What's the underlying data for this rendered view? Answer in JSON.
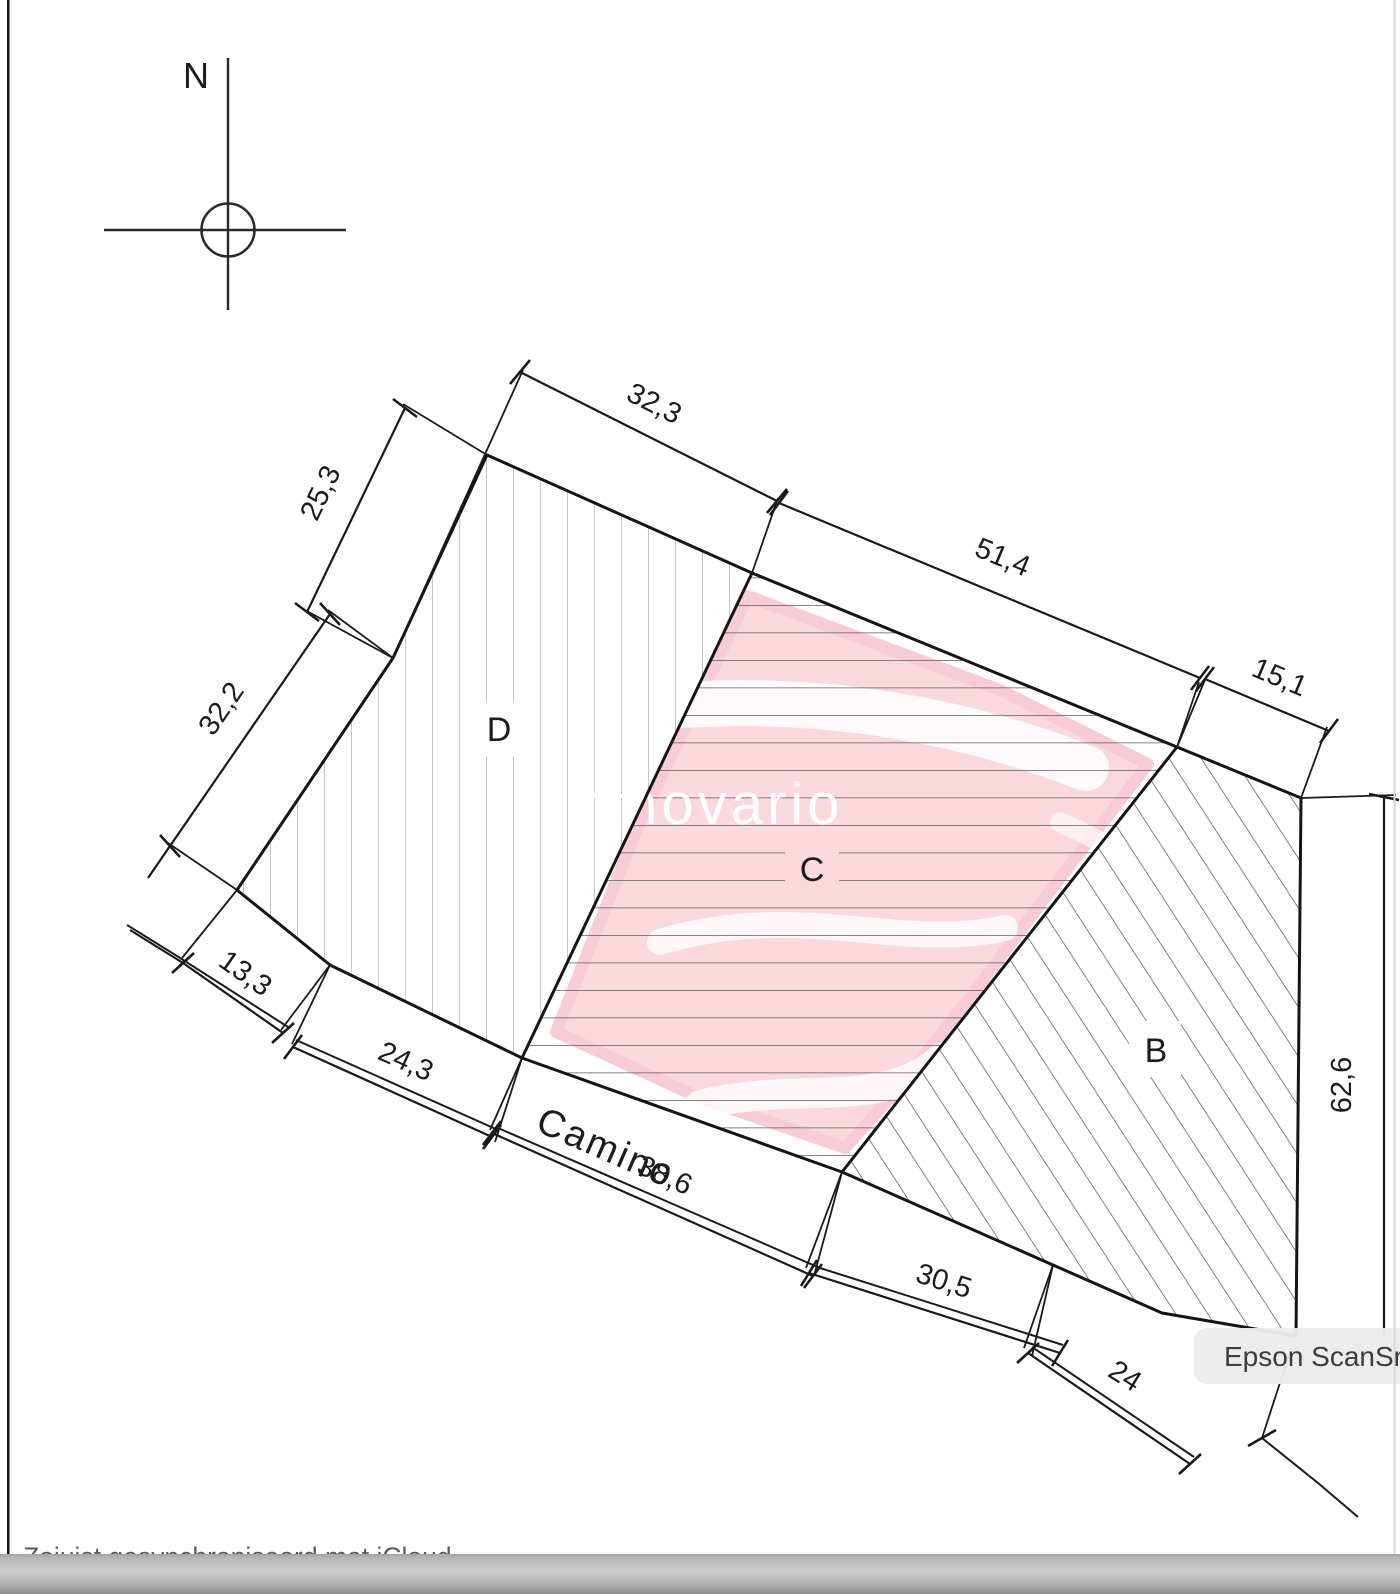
{
  "compass": {
    "label": "N"
  },
  "parcels": [
    {
      "label": "D",
      "hatch": "vertical"
    },
    {
      "label": "C",
      "hatch": "horizontal"
    },
    {
      "label": "B",
      "hatch": "diagonal"
    }
  ],
  "road": {
    "label": "Camino"
  },
  "dimensions": [
    {
      "label": "32,3"
    },
    {
      "label": "25,3"
    },
    {
      "label": "51,4"
    },
    {
      "label": "15,1"
    },
    {
      "label": "32,2"
    },
    {
      "label": "13,3"
    },
    {
      "label": "24,3"
    },
    {
      "label": "38,6"
    },
    {
      "label": "30,5"
    },
    {
      "label": "24"
    },
    {
      "label": "62,6"
    }
  ],
  "watermark": {
    "text": "inmovario",
    "pink": "#f9d8de"
  },
  "scan_overlay": {
    "label": "Epson ScanSmart",
    "bg": "#ebebeb"
  },
  "footer": {
    "status": "Zojuist gesynchroniseerd met iCloud"
  }
}
